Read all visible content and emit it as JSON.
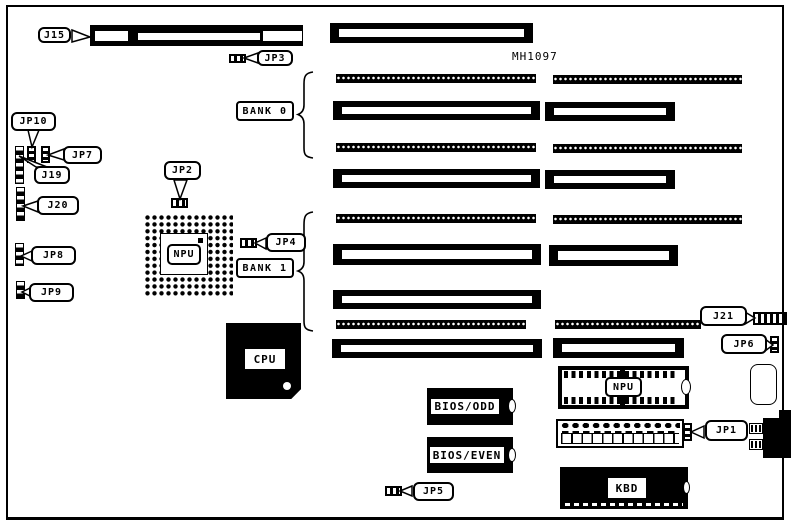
{
  "board": {
    "model_number": "MH1097"
  },
  "labels": {
    "j15": "J15",
    "jp3": "JP3",
    "jp10": "JP10",
    "jp7": "JP7",
    "j19": "J19",
    "j20": "J20",
    "jp8": "JP8",
    "jp9": "JP9",
    "jp2": "JP2",
    "jp4": "JP4",
    "bank0": "BANK 0",
    "bank1": "BANK 1",
    "j21": "J21",
    "jp6": "JP6",
    "jp1": "JP1",
    "jp5": "JP5"
  },
  "chips": {
    "npu_socket": "NPU",
    "cpu": "CPU",
    "npu_dip": "NPU",
    "bios_odd": "BIOS/ODD",
    "bios_even": "BIOS/EVEN",
    "kbd": "KBD"
  },
  "colors": {
    "ink": "#000000",
    "paper": "#ffffff"
  }
}
